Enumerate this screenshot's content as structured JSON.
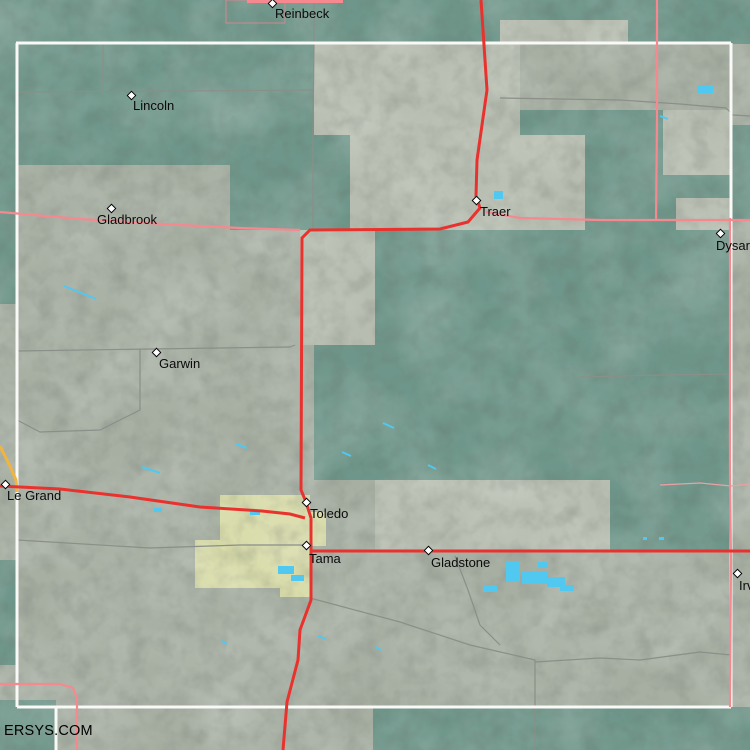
{
  "watermark": "ERSYS.COM",
  "colors": {
    "terrain_gray": "#a7afa3",
    "terrain_light": "#b7bdb0",
    "terrain_teal": "#6f968a",
    "urban": "#d9dcab",
    "water": "#50c8f0",
    "road_red": "#e9322e",
    "road_pink": "#f5898f",
    "road_pink_faint": "#e8a2a4",
    "road_gray": "#8a8f88",
    "road_orange": "#f0b440",
    "boundary_white": "#f9f9f7",
    "town_outline": "#cf8890",
    "label_color": "#0a0a0a"
  },
  "towns": [
    {
      "name": "Reinbeck",
      "marker": [
        273,
        4
      ],
      "label": [
        275,
        7
      ]
    },
    {
      "name": "Lincoln",
      "marker": [
        132,
        96
      ],
      "label": [
        133,
        99
      ]
    },
    {
      "name": "Gladbrook",
      "marker": [
        112,
        209
      ],
      "label": [
        97,
        213
      ]
    },
    {
      "name": "Traer",
      "marker": [
        477,
        201
      ],
      "label": [
        480,
        205
      ]
    },
    {
      "name": "Dysart",
      "marker": [
        721,
        234
      ],
      "label": [
        716,
        239
      ]
    },
    {
      "name": "Garwin",
      "marker": [
        157,
        353
      ],
      "label": [
        159,
        357
      ]
    },
    {
      "name": "Le Grand",
      "marker": [
        6,
        485
      ],
      "label": [
        7,
        489
      ]
    },
    {
      "name": "Toledo",
      "marker": [
        307,
        503
      ],
      "label": [
        310,
        507
      ]
    },
    {
      "name": "Tama",
      "marker": [
        307,
        546
      ],
      "label": [
        309,
        552
      ]
    },
    {
      "name": "Gladstone",
      "marker": [
        429,
        551
      ],
      "label": [
        431,
        556
      ]
    },
    {
      "name": "Irving",
      "marker": [
        738,
        574
      ],
      "label": [
        739,
        579
      ]
    }
  ],
  "map": {
    "teal_patches": [
      [
        0,
        0,
        750,
        44
      ],
      [
        17,
        44,
        297,
        121
      ],
      [
        230,
        165,
        84,
        65
      ],
      [
        314,
        130,
        36,
        100
      ],
      [
        520,
        110,
        211,
        120
      ],
      [
        375,
        230,
        356,
        250
      ],
      [
        314,
        345,
        61,
        135
      ],
      [
        610,
        480,
        121,
        71
      ],
      [
        0,
        44,
        17,
        260
      ],
      [
        0,
        560,
        17,
        105
      ],
      [
        0,
        700,
        56,
        50
      ],
      [
        373,
        707,
        377,
        43
      ],
      [
        731,
        125,
        19,
        95
      ]
    ],
    "light_patches": [
      [
        314,
        44,
        206,
        91
      ],
      [
        500,
        20,
        128,
        24
      ],
      [
        350,
        135,
        235,
        95
      ],
      [
        300,
        230,
        75,
        115
      ],
      [
        663,
        110,
        68,
        65
      ],
      [
        676,
        198,
        55,
        32
      ],
      [
        375,
        480,
        235,
        71
      ]
    ],
    "urban_patches": [
      [
        220,
        495,
        90,
        50
      ],
      [
        195,
        540,
        117,
        48
      ],
      [
        310,
        512,
        16,
        34
      ],
      [
        280,
        585,
        30,
        12
      ]
    ],
    "water_rects": [
      [
        494,
        191,
        9,
        8
      ],
      [
        697,
        85,
        16,
        8
      ],
      [
        506,
        562,
        14,
        20
      ],
      [
        522,
        571,
        26,
        13
      ],
      [
        547,
        577,
        18,
        10
      ],
      [
        483,
        585,
        14,
        7
      ],
      [
        538,
        562,
        10,
        6
      ],
      [
        560,
        585,
        14,
        6
      ],
      [
        278,
        566,
        16,
        8
      ],
      [
        291,
        575,
        13,
        6
      ],
      [
        643,
        537,
        4,
        3
      ],
      [
        659,
        537,
        5,
        3
      ],
      [
        154,
        508,
        8,
        4
      ],
      [
        250,
        511,
        10,
        4
      ]
    ],
    "water_strokes": [
      [
        [
          64,
          286
        ],
        [
          96,
          299
        ]
      ],
      [
        [
          142,
          467
        ],
        [
          160,
          473
        ]
      ],
      [
        [
          236,
          444
        ],
        [
          247,
          448
        ]
      ],
      [
        [
          342,
          452
        ],
        [
          351,
          456
        ]
      ],
      [
        [
          428,
          465
        ],
        [
          436,
          469
        ]
      ],
      [
        [
          383,
          423
        ],
        [
          394,
          428
        ]
      ],
      [
        [
          318,
          636
        ],
        [
          326,
          639
        ]
      ],
      [
        [
          222,
          641
        ],
        [
          227,
          644
        ]
      ],
      [
        [
          660,
          116
        ],
        [
          668,
          119
        ]
      ],
      [
        [
          376,
          647
        ],
        [
          381,
          650
        ]
      ]
    ],
    "roads_gray": [
      [
        [
          314,
          0
        ],
        [
          314,
          44
        ],
        [
          313,
          130
        ],
        [
          313,
          230
        ]
      ],
      [
        [
          17,
          92
        ],
        [
          180,
          91
        ],
        [
          314,
          90
        ]
      ],
      [
        [
          103,
          44
        ],
        [
          103,
          91
        ]
      ],
      [
        [
          17,
          351
        ],
        [
          150,
          349
        ],
        [
          290,
          347
        ],
        [
          295,
          345
        ]
      ],
      [
        [
          140,
          349
        ],
        [
          140,
          410
        ],
        [
          100,
          430
        ],
        [
          40,
          432
        ],
        [
          17,
          420
        ]
      ],
      [
        [
          17,
          540
        ],
        [
          150,
          548
        ],
        [
          240,
          545
        ],
        [
          305,
          545
        ]
      ],
      [
        [
          310,
          598
        ],
        [
          400,
          622
        ],
        [
          470,
          645
        ],
        [
          535,
          660
        ],
        [
          535,
          750
        ]
      ],
      [
        [
          535,
          662
        ],
        [
          600,
          658
        ],
        [
          640,
          660
        ],
        [
          700,
          652
        ],
        [
          731,
          655
        ]
      ],
      [
        [
          455,
          556
        ],
        [
          468,
          590
        ],
        [
          480,
          625
        ],
        [
          500,
          645
        ]
      ],
      [
        [
          500,
          98
        ],
        [
          620,
          100
        ],
        [
          680,
          104
        ],
        [
          726,
          108
        ],
        [
          733,
          115
        ],
        [
          750,
          116
        ]
      ],
      [
        [
          580,
          377
        ],
        [
          660,
          375
        ],
        [
          731,
          374
        ]
      ]
    ],
    "roads_pink": [
      [
        [
          0,
          212
        ],
        [
          80,
          219
        ],
        [
          180,
          225
        ],
        [
          240,
          228
        ],
        [
          300,
          230
        ]
      ],
      [
        [
          657,
          0
        ],
        [
          657,
          120
        ],
        [
          656,
          220
        ]
      ],
      [
        [
          486,
          212
        ],
        [
          520,
          218
        ],
        [
          600,
          220
        ],
        [
          750,
          220
        ]
      ],
      [
        [
          730,
          218
        ],
        [
          730,
          470
        ],
        [
          731,
          560
        ],
        [
          730,
          707
        ]
      ],
      [
        [
          0,
          684
        ],
        [
          60,
          684
        ],
        [
          73,
          688
        ],
        [
          77,
          698
        ],
        [
          77,
          750
        ]
      ]
    ],
    "roads_pink_thick": [
      [
        [
          247,
          1
        ],
        [
          343,
          1
        ]
      ]
    ],
    "roads_pink_faint": [
      [
        [
          660,
          485
        ],
        [
          700,
          483
        ],
        [
          731,
          486
        ],
        [
          750,
          484
        ]
      ]
    ],
    "roads_orange": [
      [
        [
          0,
          446
        ],
        [
          10,
          466
        ],
        [
          16,
          480
        ],
        [
          17,
          492
        ]
      ]
    ],
    "roads_red": [
      [
        [
          481,
          0
        ],
        [
          487,
          90
        ],
        [
          477,
          160
        ],
        [
          476,
          196
        ],
        [
          480,
          208
        ],
        [
          468,
          222
        ],
        [
          440,
          229
        ],
        [
          310,
          230
        ],
        [
          302,
          238
        ],
        [
          301,
          490
        ],
        [
          306,
          502
        ],
        [
          311,
          518
        ],
        [
          311,
          600
        ],
        [
          300,
          630
        ],
        [
          298,
          660
        ],
        [
          287,
          702
        ],
        [
          283,
          750
        ]
      ],
      [
        [
          0,
          486
        ],
        [
          60,
          489
        ],
        [
          130,
          497
        ],
        [
          200,
          507
        ],
        [
          262,
          511
        ],
        [
          290,
          514
        ],
        [
          305,
          518
        ]
      ],
      [
        [
          311,
          551
        ],
        [
          500,
          551
        ],
        [
          733,
          551
        ],
        [
          750,
          551
        ]
      ]
    ],
    "boundary_white": [
      [
        [
          16,
          43
        ],
        [
          731,
          43
        ]
      ],
      [
        [
          17,
          43
        ],
        [
          17,
          707
        ]
      ],
      [
        [
          731,
          43
        ],
        [
          731,
          707
        ]
      ],
      [
        [
          17,
          707
        ],
        [
          731,
          707
        ]
      ],
      [
        [
          56,
          707
        ],
        [
          56,
          750
        ]
      ]
    ],
    "town_outline_rect": [
      226,
      0,
      59,
      23
    ]
  }
}
